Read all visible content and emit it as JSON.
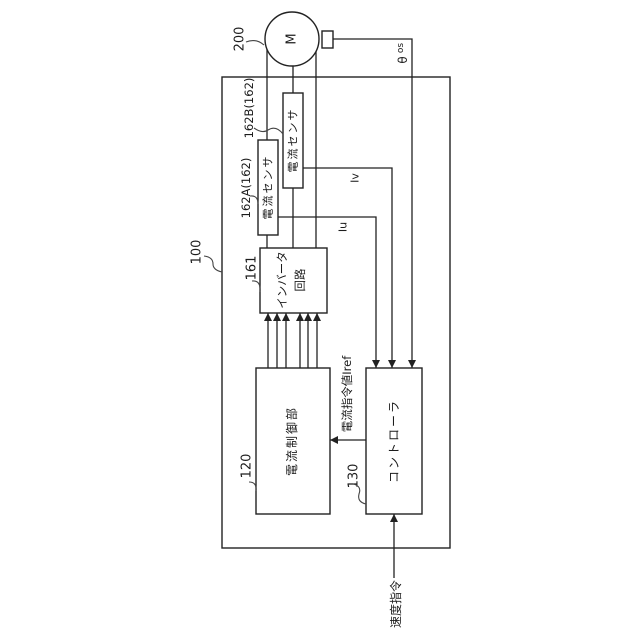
{
  "diagram": {
    "system": {
      "ref": "100"
    },
    "motor": {
      "label": "M",
      "ref": "200"
    },
    "sensors": {
      "a": {
        "ref": "162A(162)",
        "label": "電流センサ",
        "signal": "Iu"
      },
      "b": {
        "ref": "162B(162)",
        "label": "電流センサ",
        "signal": "Iv"
      }
    },
    "inverter": {
      "ref": "161",
      "label_line1": "インバータ",
      "label_line2": "回路"
    },
    "current_control": {
      "ref": "120",
      "label": "電流制御部"
    },
    "controller": {
      "ref": "130",
      "label": "コントローラ"
    },
    "signals": {
      "rotor_position": {
        "symbol": "θ",
        "subscript": "os"
      },
      "current_command": "電流指令値Iref",
      "speed_command": "速度指令"
    },
    "colors": {
      "line": "#222222",
      "background": "#ffffff"
    }
  }
}
